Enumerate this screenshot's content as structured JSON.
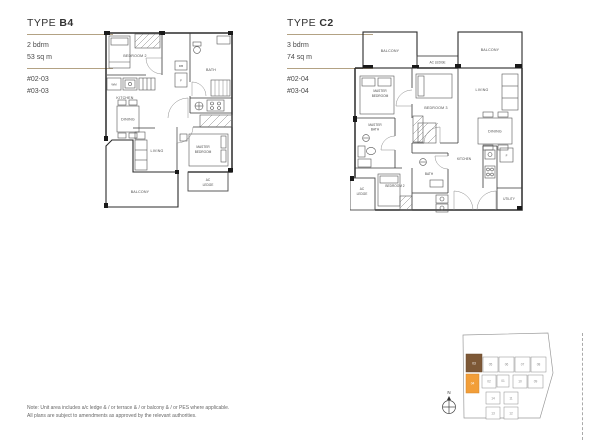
{
  "plan_b4": {
    "title_prefix": "TYPE ",
    "title_code": "B4",
    "spec_line1": "2 bdrm",
    "spec_line2": "53 sq m",
    "unit_line1": "#02-03",
    "unit_line2": "#03-03",
    "labels": {
      "bedroom2": "BEDROOM 2",
      "bath": "BATH",
      "kitchen": "KITCHEN",
      "dining": "DINING",
      "living": "LIVING",
      "master_line1": "MASTER",
      "master_line2": "BEDROOM",
      "ac_ledge_line1": "AC",
      "ac_ledge_line2": "LEDGE",
      "balcony": "BALCONY",
      "wm": "WM",
      "fridge": "F",
      "db": "DB"
    }
  },
  "plan_c2": {
    "title_prefix": "TYPE ",
    "title_code": "C2",
    "spec_line1": "3 bdrm",
    "spec_line2": "74 sq m",
    "unit_line1": "#02-04",
    "unit_line2": "#03-04",
    "labels": {
      "balcony_left": "BALCONY",
      "balcony_right": "BALCONY",
      "ac_ledge_top": "AC LEDGE",
      "master_line1": "MASTER",
      "master_line2": "BEDROOM",
      "bedroom3": "BEDROOM 3",
      "living": "LIVING",
      "dining": "DINING",
      "master_bath_line1": "MASTER",
      "master_bath_line2": "BATH",
      "ac_ledge_left_line1": "AC",
      "ac_ledge_left_line2": "LEDGE",
      "bedroom2": "BEDROOM 2",
      "bath": "BATH",
      "kitchen": "KITCHEN",
      "utility": "UTILITY",
      "fridge": "F"
    }
  },
  "note": {
    "line1": "Note: Unit area includes a/c ledge & / or terrace & / or balcony & / or PES where applicable.",
    "line2": "All plans are subject to amendments as approved by the relevant authorities."
  },
  "keyplan": {
    "compass_label": "N",
    "units": [
      {
        "num": "03",
        "highlight": "dark"
      },
      {
        "num": "05",
        "highlight": "none"
      },
      {
        "num": "06",
        "highlight": "none"
      },
      {
        "num": "07",
        "highlight": "none"
      },
      {
        "num": "08",
        "highlight": "none"
      },
      {
        "num": "04",
        "highlight": "orange"
      },
      {
        "num": "02",
        "highlight": "none"
      },
      {
        "num": "01",
        "highlight": "none"
      },
      {
        "num": "10",
        "highlight": "none"
      },
      {
        "num": "09",
        "highlight": "none"
      },
      {
        "num": "14",
        "highlight": "none"
      },
      {
        "num": "11",
        "highlight": "none"
      },
      {
        "num": "13",
        "highlight": "none"
      },
      {
        "num": "12",
        "highlight": "none"
      }
    ]
  },
  "colors": {
    "rule": "#b3a284",
    "highlight_dark": "#7d5836",
    "highlight_orange": "#f29e38"
  }
}
